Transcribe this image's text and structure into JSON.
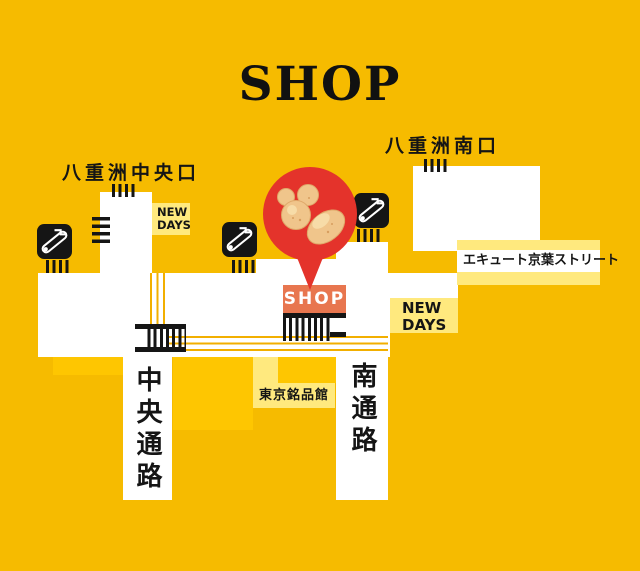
{
  "title": "SHOP",
  "exits": {
    "central": "八重洲中央口",
    "south": "八重洲南口"
  },
  "shops": {
    "new_days_small": {
      "lines": [
        "NEW",
        "DAYS"
      ]
    },
    "new_days_large": {
      "lines": [
        "NEW",
        "DAYS"
      ]
    },
    "ecute_keiyo_street": "エキュート京葉ストリート",
    "tokyo_meihinkan": "東京銘品館"
  },
  "passages": {
    "central": "中央通路",
    "south": "南通路"
  },
  "marker": {
    "label": "SHOP"
  },
  "icons": [
    "escalator-icon",
    "ticket-gate-icon",
    "stairs-icon",
    "map-pin-icon",
    "cookie-sweets-image"
  ],
  "colors": {
    "background": "#F6BB00",
    "corridor_white": "#FFFFFF",
    "pale_yellow": "#FFE97E",
    "accent_gold": "#FEC601",
    "marker_red": "#E4332B",
    "shop_orange": "#E8764F",
    "cookie_beige": "#F0C58B",
    "route_line": "#F2AF00",
    "symbol_black": "#151515"
  }
}
